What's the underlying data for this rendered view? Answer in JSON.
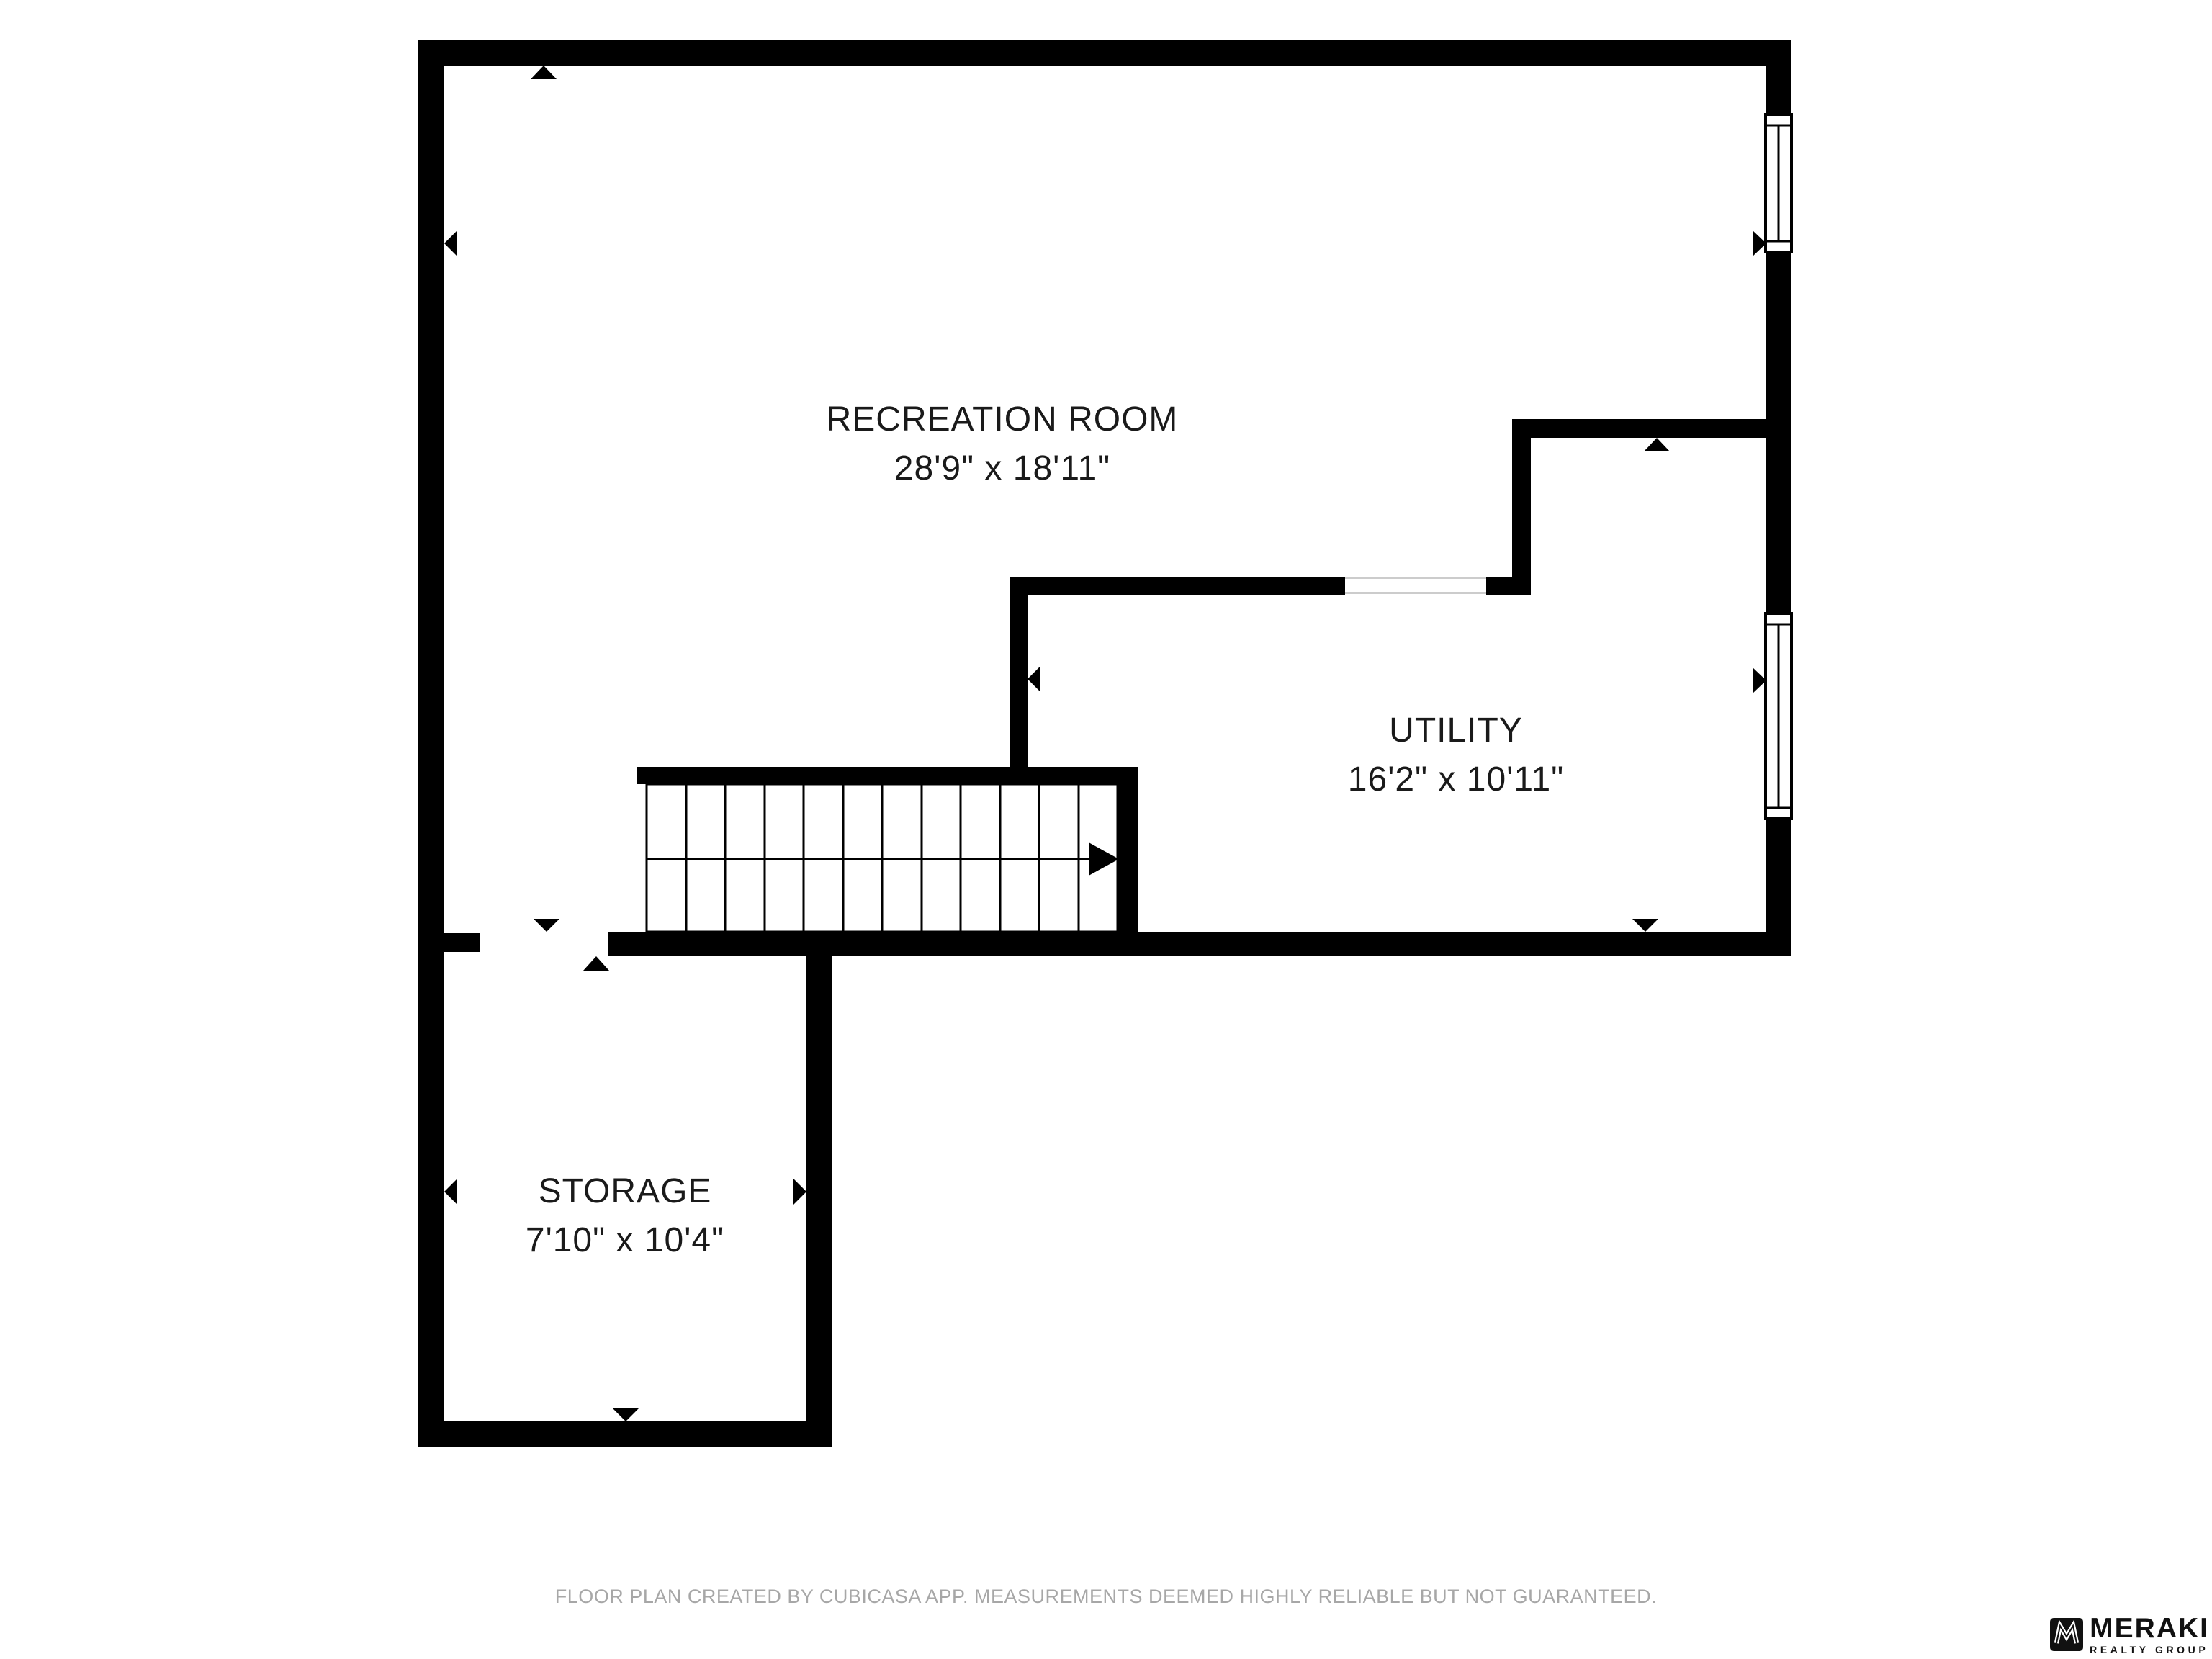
{
  "rooms": {
    "recreation": {
      "name": "RECREATION ROOM",
      "dimensions": "28'9\" x 18'11\""
    },
    "utility": {
      "name": "UTILITY",
      "dimensions": "16'2\" x 10'11\""
    },
    "storage": {
      "name": "STORAGE",
      "dimensions": "7'10\" x 10'4\""
    }
  },
  "footer": {
    "disclaimer": "FLOOR PLAN CREATED BY CUBICASA APP. MEASUREMENTS DEEMED HIGHLY RELIABLE BUT NOT GUARANTEED."
  },
  "branding": {
    "logo_name": "MERAKI",
    "logo_tagline": "REALTY GROUP"
  },
  "colors": {
    "wall": "#000000",
    "label_text": "#1a1a1a",
    "footer_text": "#a7a7a7",
    "opening_line": "#cccccc",
    "background": "#ffffff"
  }
}
